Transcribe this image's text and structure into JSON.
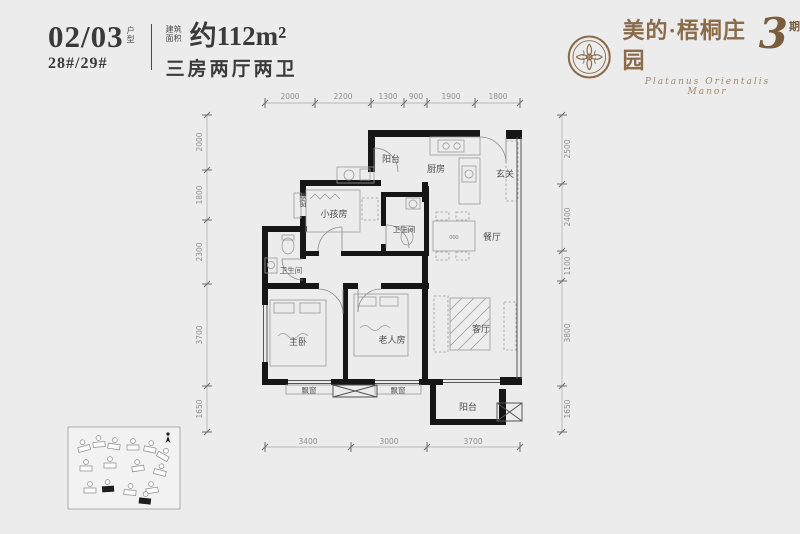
{
  "header": {
    "unit_number": "02/03",
    "unit_suffix": "户型",
    "building_numbers": "28#/29#",
    "area_prefix": "建筑面积",
    "area_value": "约112m²",
    "layout_type": "三房两厅两卫"
  },
  "brand": {
    "name": "美的·梧桐庄园",
    "phase_number": "3",
    "phase_suffix": "期",
    "subtitle": "Platanus Orientalis Manor",
    "color": "#8a6b4a"
  },
  "plan": {
    "rooms": {
      "balcony_top": "阳台",
      "kitchen": "厨房",
      "entry": "玄关",
      "bay_window_left": "飘窗",
      "kids_room": "小孩房",
      "bath_1": "卫生间",
      "dining": "餐厅",
      "bath_2": "卫生间",
      "master_bedroom": "主卧",
      "elder_room": "老人房",
      "living_room": "客厅",
      "bay_window_bottom_1": "飘窗",
      "bay_window_bottom_2": "飘窗",
      "balcony_bottom": "阳台",
      "dining_table_label": "000"
    },
    "dims_top": [
      "2000",
      "2200",
      "1300",
      "900",
      "1900",
      "1800"
    ],
    "dims_left": [
      "2000",
      "1800",
      "2300",
      "3700",
      "1650"
    ],
    "dims_right": [
      "2500",
      "2400",
      "1100",
      "3800",
      "1650"
    ],
    "dims_bottom": [
      "3400",
      "3000",
      "3700"
    ]
  },
  "colors": {
    "background": "#ececec",
    "wall": "#161616",
    "header_text": "#3a3a3a",
    "brand_gold": "#8a6b4a"
  }
}
